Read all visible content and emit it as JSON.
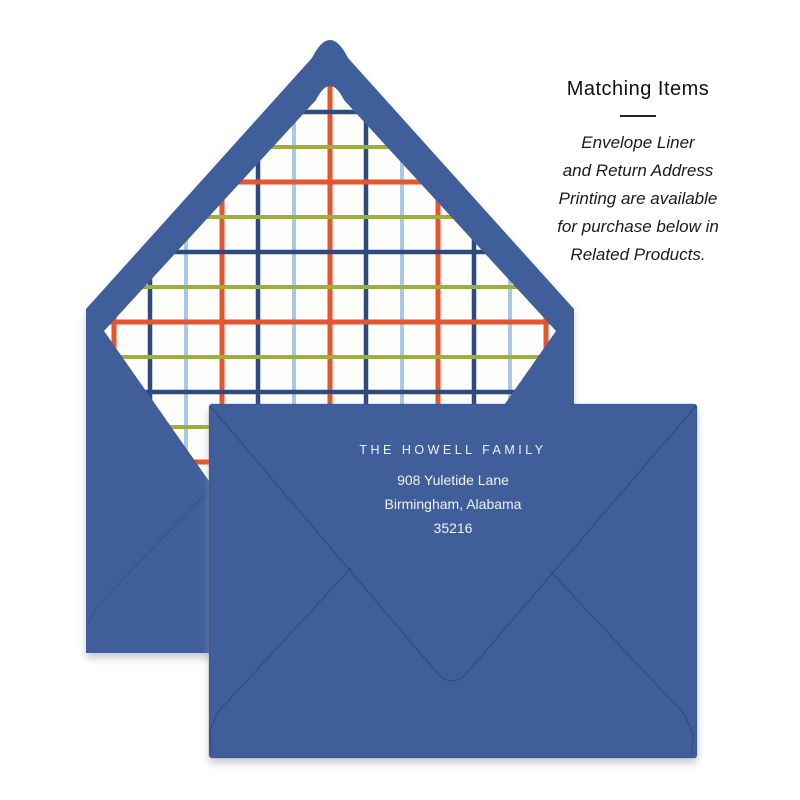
{
  "matching_items": {
    "title": "Matching Items",
    "lines": [
      "Envelope Liner",
      "and Return Address",
      "Printing are available",
      "for purchase below in",
      "Related Products."
    ]
  },
  "address": {
    "name": "THE HOWELL FAMILY",
    "street": "908 Yuletide Lane",
    "city_state": "Birmingham, Alabama",
    "zip": "35216"
  },
  "colors": {
    "envelope_blue": "#3F5E9A",
    "fold_line": "#2B4679",
    "liner_bg": "#FDFDFC",
    "plaid_orange": "#E5552D",
    "plaid_navy": "#2D4B7E",
    "plaid_light_blue": "#A9C7E6",
    "plaid_green": "#9FAE3D",
    "heading_text": "#111111",
    "body_text": "#1B1B1B",
    "address_text": "#EDF1F6",
    "page_background": "#FFFFFF"
  }
}
